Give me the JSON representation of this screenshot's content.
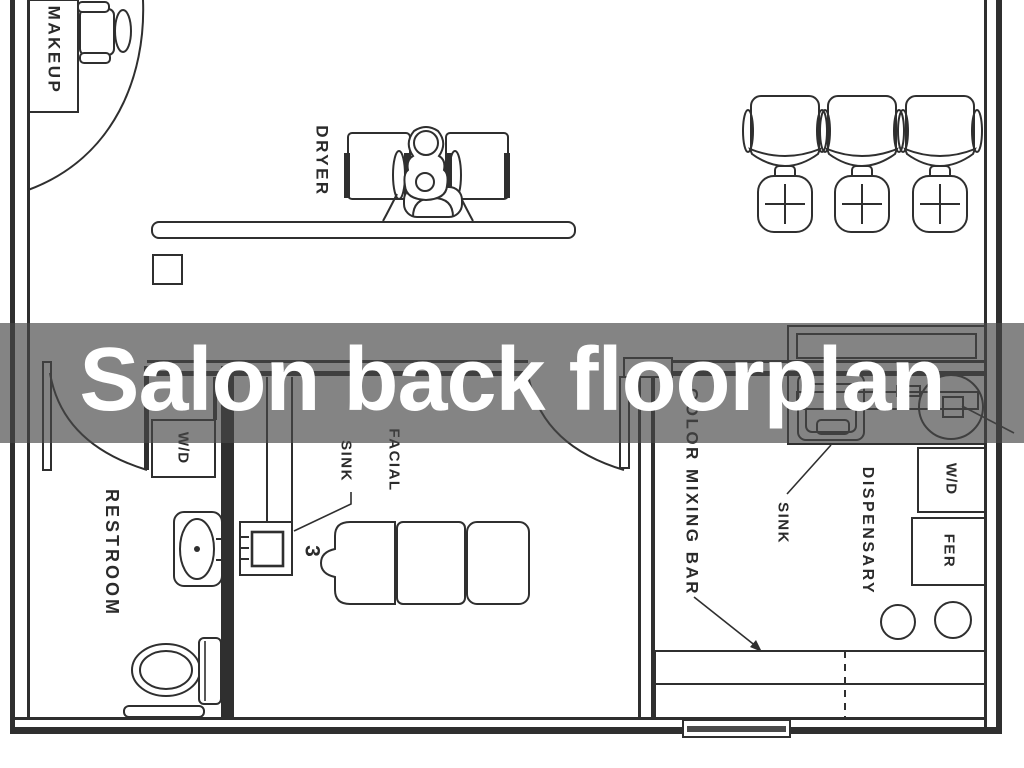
{
  "banner": {
    "title": "Salon back floorplan",
    "background": "rgba(72,72,72,0.67)",
    "text_color": "#ffffff"
  },
  "floorplan": {
    "line_color": "#2f2f2f",
    "background": "#ffffff",
    "labels": {
      "makeup": "MAKEUP",
      "dryer": "DRYER",
      "restroom": "RESTROOM",
      "washer_dryer_left": "W/D",
      "facial": "FACIAL",
      "facial_sink": "SINK",
      "faucet_number": "3",
      "color_mixing_bar": "COLOR MIXING BAR",
      "shampoo_sink": "SINK",
      "dispensary": "DISPENSARY",
      "washer_dryer_right": "W/D",
      "fridge": "FER"
    }
  }
}
